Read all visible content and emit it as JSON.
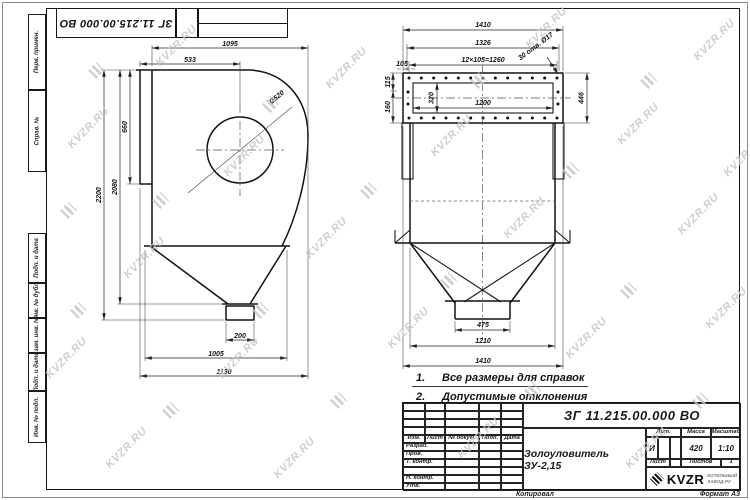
{
  "sheet": {
    "designation_top": "ЗГ 11.215.00.000 ВО",
    "copied_label": "Копировал",
    "format_label": "Формат А3",
    "watermark": {
      "text": "KVZR.RU"
    }
  },
  "margin_labels": {
    "perv_primen": "Перв. примен.",
    "sprav_no": "Справ. №",
    "podp_data1": "Подп. и дата",
    "inv_dubl": "Инв. № дубл.",
    "vzam_inv": "Взам. инв. №",
    "podp_data2": "Подп. и дата",
    "inv_podl": "Инв. № подл."
  },
  "views": {
    "left": {
      "dims": {
        "top_width": "1095",
        "inlet_offset": "533",
        "inlet_height": "660",
        "outlet_dia": "Ø520",
        "height_outer": "2200",
        "height_inner": "2080",
        "outlet_width": "200",
        "base_width": "1005",
        "overall_width": "1130"
      }
    },
    "right": {
      "dims": {
        "overall_top": "1410",
        "flange_width": "1326",
        "holes_pitch": "12×105=1260",
        "edge_pitch": "105",
        "holes_note": "30 отв. Ø17",
        "opening_width": "1200",
        "edge_v1": "115",
        "edge_v2": "160",
        "opening_height": "320",
        "flange_height": "446",
        "outlet_width": "475",
        "cone_width": "1210",
        "overall_bottom": "1410"
      }
    }
  },
  "notes": [
    {
      "num": "1.",
      "text": "Все размеры для справок"
    },
    {
      "num": "2.",
      "text": "Допустимые отклонения  ±50 мм"
    }
  ],
  "title_block": {
    "designation": "ЗГ 11.215.00.000  ВО",
    "name": "Золоуловитель ЗУ-2,15",
    "headers": {
      "izm": "Изм.",
      "list": "Лист",
      "doc": "№ докум.",
      "podp": "Подп.",
      "data": "Дата",
      "lit": "Лит.",
      "massa": "Масса",
      "masshtab": "Масштаб",
      "list2": "Лист",
      "listov": "Листов"
    },
    "rows": {
      "razrab": "Разраб.",
      "prov": "Пров.",
      "tkontr": "Т. контр.",
      "nkontr": "Н. контр.",
      "utv": "Утв."
    },
    "values": {
      "lit": "И",
      "massa": "420",
      "scale": "1:10",
      "listov_val": "1"
    },
    "company": {
      "logo_text": "KVZR",
      "sub1": "КОТЕЛЬНЫЙ",
      "sub2": "ЗАВОД.РУ"
    }
  }
}
